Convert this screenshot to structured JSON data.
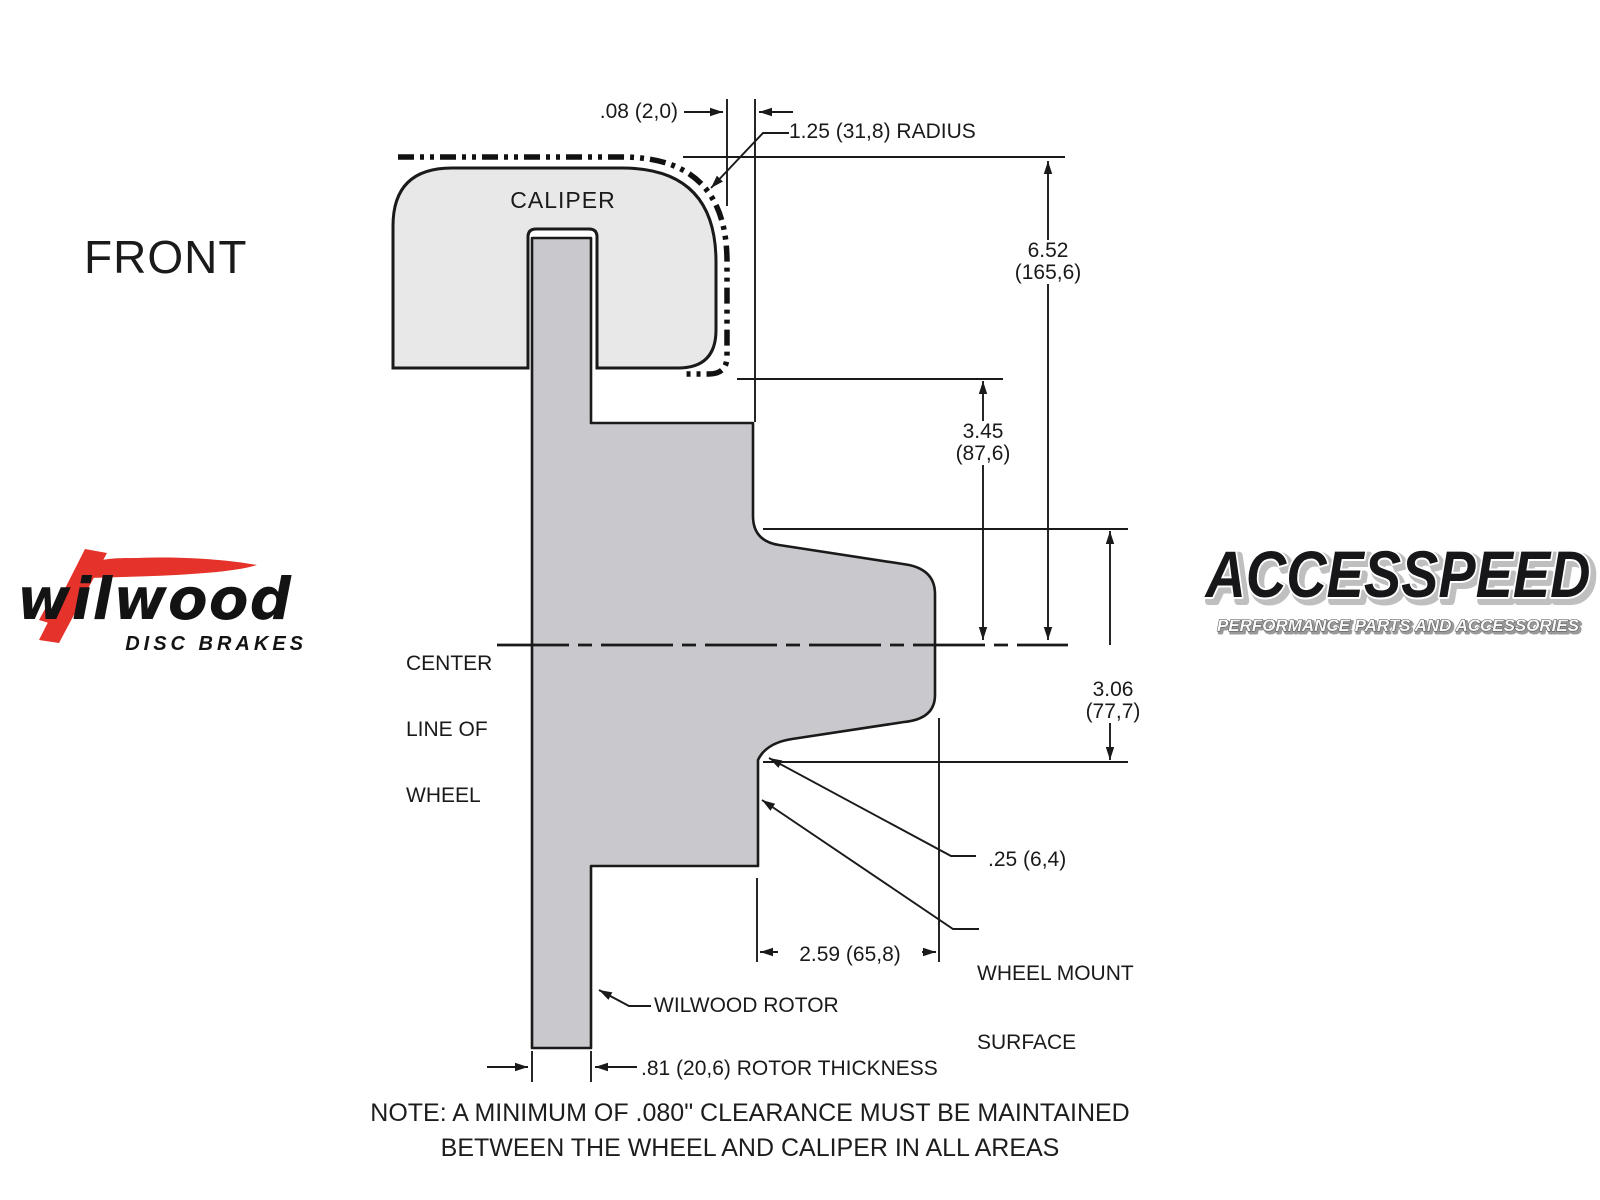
{
  "colors": {
    "background": "#ffffff",
    "line": "#1a1a1a",
    "caliper_fill": "#e8e8e8",
    "rotor_fill": "#c9c9cd",
    "wilwood_red": "#e5322a"
  },
  "view_label": "FRONT",
  "diagram": {
    "caliper_label": "CALIPER",
    "centerline_label": {
      "line1": "CENTER",
      "line2": "LINE OF",
      "line3": "WHEEL"
    },
    "rotor_label": "WILWOOD ROTOR",
    "wheel_mount_label": {
      "line1": "WHEEL MOUNT",
      "line2": "SURFACE"
    },
    "dimensions": {
      "caliper_wheel_clearance": ".08 (2,0)",
      "caliper_radius": "1.25 (31,8) RADIUS",
      "caliper_height_in": "6.52",
      "caliper_height_mm": "(165,6)",
      "caliper_to_center_in": "3.45",
      "caliper_to_center_mm": "(87,6)",
      "center_to_mount_in": "3.06",
      "center_to_mount_mm": "(77,7)",
      "flange_offset": ".25 (6,4)",
      "mount_depth": "2.59 (65,8)",
      "rotor_thickness": ".81 (20,6) ROTOR THICKNESS"
    },
    "note_line1": "NOTE: A MINIMUM OF .080\" CLEARANCE MUST BE MAINTAINED",
    "note_line2": "BETWEEN THE WHEEL AND CALIPER IN ALL AREAS"
  },
  "logos": {
    "wilwood": {
      "wordmark": "wilwood",
      "tagline": "DISC BRAKES"
    },
    "accesspeed": {
      "wordmark": "ACCESSPEED",
      "tagline": "PERFORMANCE PARTS AND ACCESSORIES"
    }
  }
}
